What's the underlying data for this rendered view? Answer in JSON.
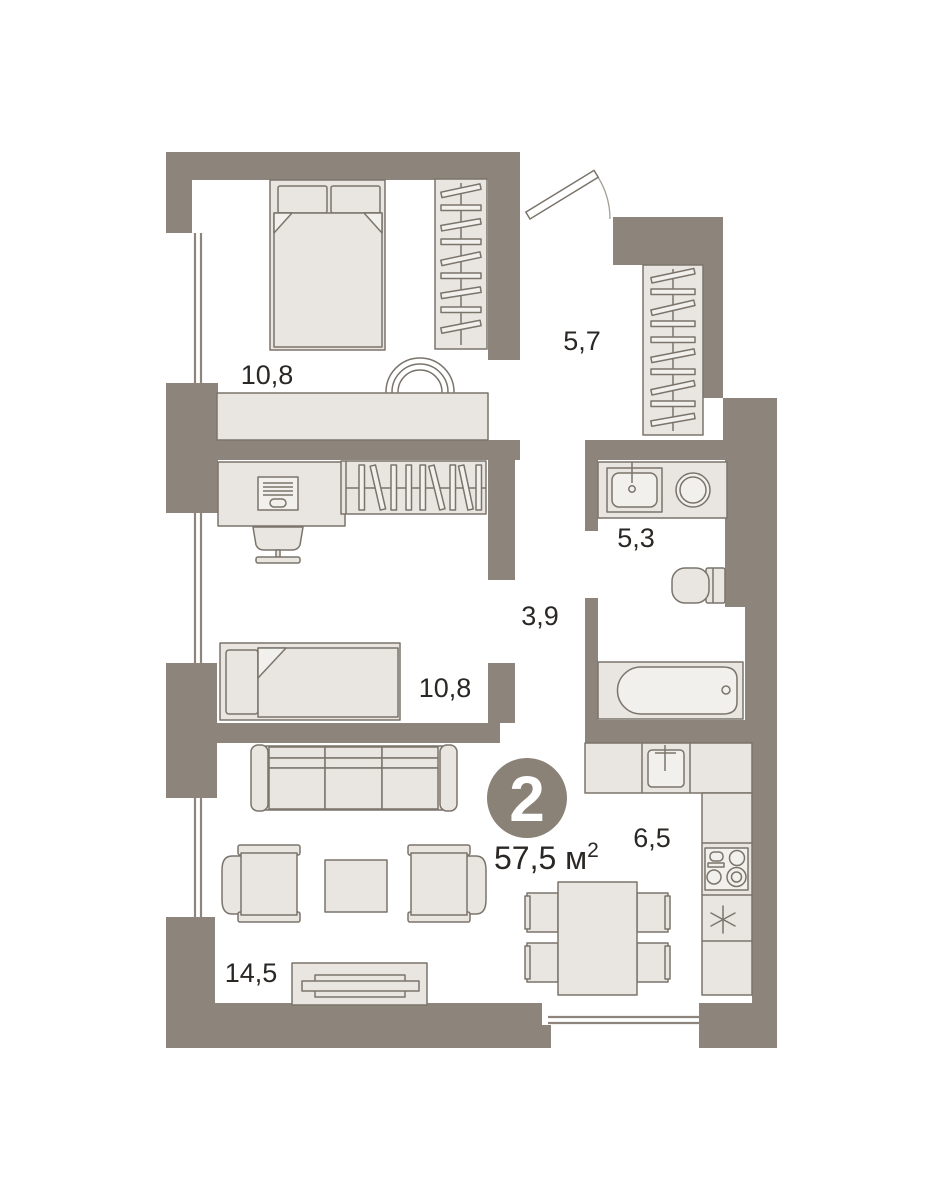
{
  "plan": {
    "badge": {
      "rooms_count": "2",
      "area_text": "57,5 м",
      "area_superscript": "2"
    },
    "rooms": [
      {
        "id": "bedroom-1",
        "area": "10,8"
      },
      {
        "id": "hallway",
        "area": "5,7"
      },
      {
        "id": "bathroom",
        "area": "5,3"
      },
      {
        "id": "corridor",
        "area": "3,9"
      },
      {
        "id": "bedroom-2",
        "area": "10,8"
      },
      {
        "id": "kitchen",
        "area": "6,5"
      },
      {
        "id": "living-room",
        "area": "14,5"
      }
    ],
    "colors": {
      "wall": "#8d857b",
      "furniture_fill": "#e9e6e2",
      "furniture_fill_light": "#f2f0ec",
      "furniture_stroke": "#7a746b",
      "window_line": "#8d857b",
      "door_arc": "#a59f97",
      "badge": "#8a8177",
      "badge_text": "#ffffff",
      "label_text": "#2a2724"
    }
  }
}
